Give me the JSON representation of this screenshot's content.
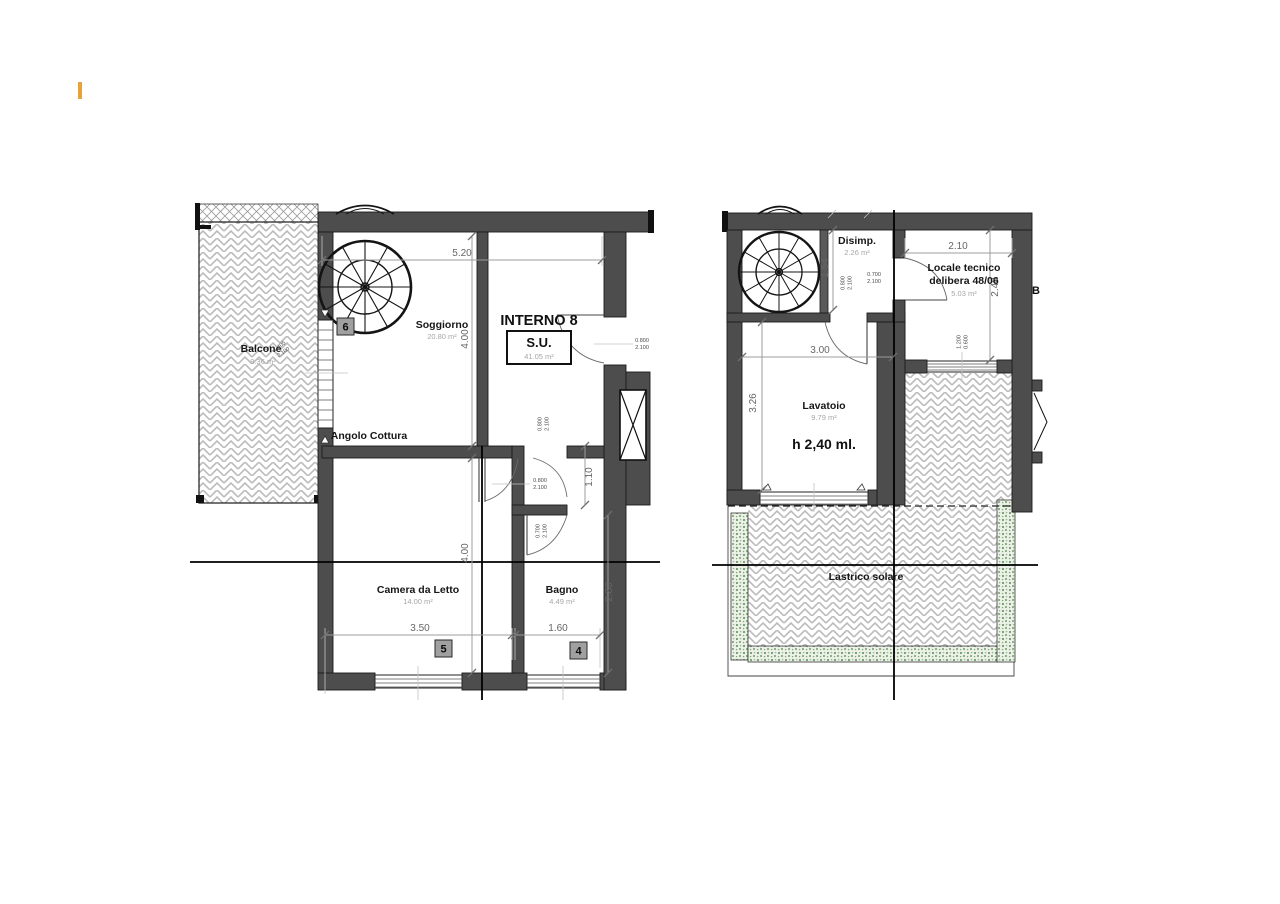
{
  "left_plan": {
    "unit": {
      "title": "INTERNO 8",
      "su_label": "S.U.",
      "su_area": "41.05 m²"
    },
    "rooms": {
      "balcone": {
        "name": "Balcone",
        "area": "9.36 m²"
      },
      "soggiorno": {
        "name": "Soggiorno",
        "area": "20.80 m²"
      },
      "angolo": {
        "name": "Angolo Cottura"
      },
      "camera": {
        "name": "Camera da Letto",
        "area": "14.00 m²"
      },
      "bagno": {
        "name": "Bagno",
        "area": "4.49 m²"
      }
    },
    "badges": {
      "b6": "6",
      "b5": "5",
      "b4": "4"
    },
    "dims": {
      "top_w": "5.20",
      "sog_h": "4.00",
      "cam_h": "4.00",
      "cam_w": "3.50",
      "bag_w": "1.60",
      "corr_h": "1.10",
      "bag_h": "2.80"
    },
    "doors": {
      "d1": {
        "w": "0.800",
        "h": "2.100"
      },
      "d2": {
        "w": "0.800",
        "h": "2.100"
      },
      "d3": {
        "w": "0.700",
        "h": "2.100"
      },
      "entry": {
        "w": "0.800",
        "h": "2.100"
      }
    },
    "window": {
      "w": "1.405",
      "h": "2.100"
    }
  },
  "right_plan": {
    "rooms": {
      "disimp": {
        "name": "Disimp.",
        "area": "2.26 m²"
      },
      "locale": {
        "name": "Locale tecnico",
        "name2": "delibera 48/06",
        "area": "5.03 m²"
      },
      "lavatoio": {
        "name": "Lavatoio",
        "area": "9.79 m²",
        "height_note": "h 2,40 ml."
      },
      "lastrico": {
        "name": "Lastrico solare"
      }
    },
    "dims": {
      "locale_w": "2.10",
      "locale_h": "2.40",
      "disimp_h": "1.54",
      "lav_w": "3.00",
      "lav_h": "3.26"
    },
    "doors": {
      "d1": {
        "w": "0.800",
        "h": "2.100"
      },
      "d2": {
        "w": "0.700",
        "h": "2.100"
      },
      "win": {
        "w": "1.200",
        "h": "0.600"
      }
    },
    "neighbor_label": "B"
  }
}
